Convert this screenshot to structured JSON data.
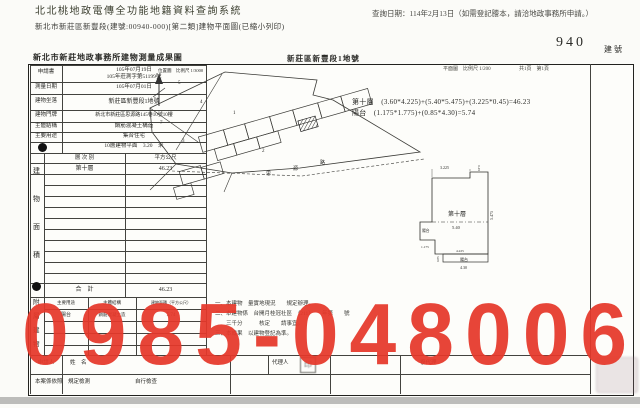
{
  "header": {
    "system_title": "北北桃地政電傳全功能地籍資料查詢系統",
    "query_date": "查詢日期：114年2月13日（如需登記謄本，請洽地政事務所申請。）",
    "subtitle": "新北市新莊區新豐段(建號:00940-000)[第二類]建物平面圖(已縮小列印)",
    "building_no": "940",
    "building_no_label": "建號"
  },
  "doc": {
    "title": "新北市新莊地政事務所建物測量成果圖",
    "land_label": "新莊區新豐段1地號",
    "plan_scale": "平面圖　比例尺 1/200",
    "page_info": "共1頁　第1頁",
    "info_rows": [
      {
        "label": "申請書",
        "value1": "105年07月19日",
        "value2": "105年莊測字第51199號"
      },
      {
        "label": "測量日期",
        "value": "105年07月01日"
      },
      {
        "label": "建物坐落",
        "value": "新莊區新豐段1地號"
      },
      {
        "label": "建物門牌",
        "value": "新北市新莊區思源路145巷10號10樓"
      },
      {
        "label": "主體結構",
        "value": "鋼筋混凝土構造"
      },
      {
        "label": "主要用途",
        "value": "集合住宅"
      },
      {
        "label": "層次",
        "value": "10層建物平面　3.20　米"
      }
    ],
    "area_table": {
      "side_label_chars": [
        "建",
        "物",
        "面",
        "積"
      ],
      "col1": "層 次 別",
      "col2": "平方公尺",
      "row_floor": "第十層",
      "row_floor_value": "46.23",
      "total_label": "合　計",
      "total_value": "46.23"
    },
    "annex_table": {
      "side_label_chars": [
        "附",
        "屬",
        "建",
        "物"
      ],
      "h1": "主要用途",
      "h2": "主體結構",
      "h3": "建物面積（平方公尺）",
      "r1c1": "陽台",
      "r1c2": "鋼筋混凝土造",
      "r1c3": "5.74"
    },
    "formulas": {
      "line1": "第十層　(3.60*4.225)+(5.40*5.475)+(3.225*0.45)=46.23",
      "line2": "陽台　(1.175*1.775)+(0.85*4.30)=5.74"
    },
    "remarks": [
      "一、本建物　量實地現況　　規定辦理。",
      "二、本建物係　台開月桂冠社區　（211）　　年第　　號",
      "　　三千分　　　核定　　請事宜。",
      "三、本成果　以建物登記為準。"
    ],
    "applicant_row": {
      "label": "申請人",
      "name_label": "姓　名",
      "agent_label": "代理人",
      "deputy_label": "複代理"
    },
    "check_row": {
      "text1": "本案係依照　規定檢測",
      "text2": "自行檢查"
    }
  },
  "site_plan": {
    "scale_label": "位置圖　比例尺 1/3000",
    "lots": [
      "5",
      "4",
      "7",
      "3",
      "1",
      "2"
    ],
    "road_chars": [
      "思",
      "源",
      "路"
    ]
  },
  "floor_plan": {
    "unit_label": "第十層",
    "balcony_left": "陽台",
    "balcony_bottom": "陽台",
    "dims": {
      "top": "3.225",
      "notch": "0.45",
      "right": "5.475",
      "mid": "5.40",
      "bal_h": "1.775",
      "bal_w": "1.175",
      "inner_bottom": "4.225",
      "strip_h": "0.85",
      "strip_w": "4.30"
    }
  },
  "watermark": {
    "text": "0985-048006",
    "color": "#e6382a"
  }
}
